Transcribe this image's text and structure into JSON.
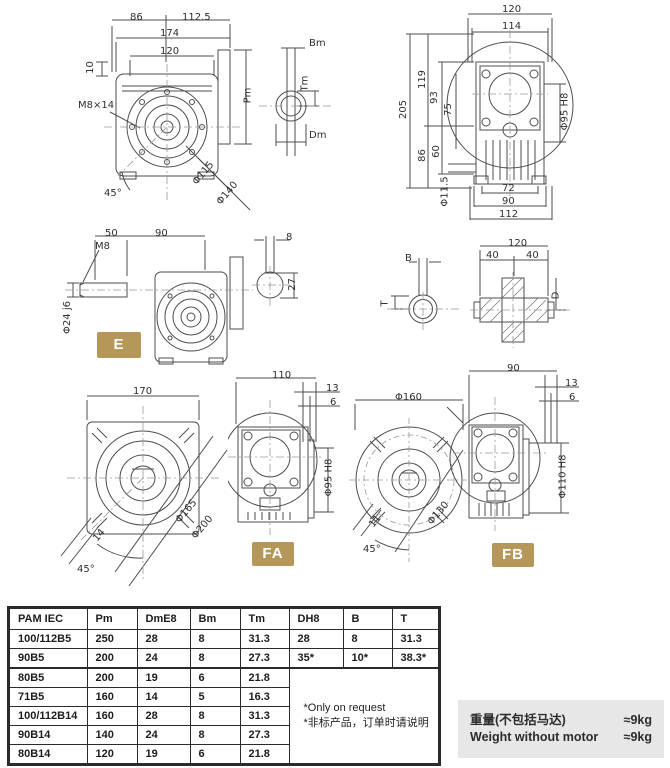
{
  "page": {
    "accent_gold": "#b5975a",
    "drawing_line_gray": "#4d4d4d",
    "weight_box_bg": "#e7e7e7"
  },
  "badges": {
    "e": "E",
    "fa": "FA",
    "fb": "FB"
  },
  "view_rear_flange": {
    "dim_86": "86",
    "dim_112_5": "112.5",
    "dim_174": "174",
    "dim_120": "120",
    "dim_10": "10",
    "thread": "M8×14",
    "angle": "45°",
    "bolt_circle": "Φ115",
    "flange_od": "Φ140",
    "dim_pm": "Pm"
  },
  "view_motor_shaft_end": {
    "dim_bm": "Bm",
    "dim_tm": "Tm",
    "dim_dm": "Dm"
  },
  "view_side_right": {
    "dim_120": "120",
    "dim_114": "114",
    "dim_205": "205",
    "dim_119": "119",
    "dim_93": "93",
    "dim_75": "75",
    "dim_86": "86",
    "dim_60": "60",
    "hole": "Φ11.5",
    "bore": "Φ95 H8",
    "dim_72": "72",
    "dim_90": "90",
    "dim_112": "112"
  },
  "view_side_left": {
    "dim_50": "50",
    "dim_90": "90",
    "thread": "M8",
    "shaft": "Φ24 j6"
  },
  "view_shaft_section_small": {
    "dim_8": "8",
    "dim_27": "27"
  },
  "view_bore_end": {
    "dim_b": "B",
    "dim_t": "T"
  },
  "view_shaft_cross_section": {
    "dim_120": "120",
    "dim_40a": "40",
    "dim_40b": "40",
    "dim_d": "D"
  },
  "view_output_flange": {
    "dim_170": "170",
    "bolt_circle": "Φ165",
    "flange_od": "Φ200",
    "dim_14": "14",
    "angle": "45°"
  },
  "view_fa": {
    "dim_110": "110",
    "dim_13": "13",
    "dim_6": "6",
    "bore": "Φ95 H8"
  },
  "view_fb_flange": {
    "flange_od": "Φ160",
    "bolt_circle": "Φ130",
    "dim_11": "11",
    "angle": "45°"
  },
  "view_fb": {
    "dim_90": "90",
    "dim_13": "13",
    "dim_6": "6",
    "bore": "Φ110 H8"
  },
  "table": {
    "headers": [
      "PAM IEC",
      "Pm",
      "DmE8",
      "Bm",
      "Tm",
      "DH8",
      "B",
      "T"
    ],
    "rows": [
      [
        "100/112B5",
        "250",
        "28",
        "8",
        "31.3",
        "28",
        "8",
        "31.3"
      ],
      [
        "90B5",
        "200",
        "24",
        "8",
        "27.3",
        "35*",
        "10*",
        "38.3*"
      ],
      [
        "80B5",
        "200",
        "19",
        "6",
        "21.8"
      ],
      [
        "71B5",
        "160",
        "14",
        "5",
        "16.3"
      ],
      [
        "100/112B14",
        "160",
        "28",
        "8",
        "31.3"
      ],
      [
        "90B14",
        "140",
        "24",
        "8",
        "27.3"
      ],
      [
        "80B14",
        "120",
        "19",
        "6",
        "21.8"
      ]
    ],
    "note_en": "*Only on request",
    "note_cn": "*非标产品，订单时请说明"
  },
  "weight": {
    "label_cn": "重量(不包括马达)",
    "label_en": "Weight without motor",
    "value_cn": "≈9kg",
    "value_en": "≈9kg"
  }
}
